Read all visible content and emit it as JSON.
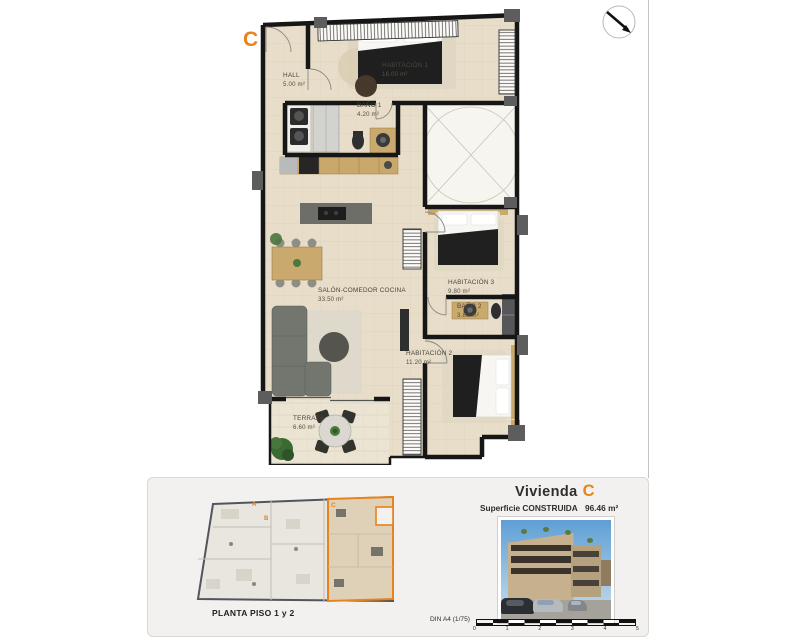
{
  "colors": {
    "accent": "#e8831c",
    "wall": "#161616",
    "floor": "#e7ddc9"
  },
  "plan": {
    "unit_letter": "C",
    "rooms": [
      {
        "name": "HALL",
        "area": "5.00 m²"
      },
      {
        "name": "HABITACIÓN 1",
        "area": "16.00 m²"
      },
      {
        "name": "BAÑO 1",
        "area": "4.20 m²"
      },
      {
        "name": "SALÓN-COMEDOR COCINA",
        "area": "33.50 m²"
      },
      {
        "name": "HABITACIÓN 3",
        "area": "9.80 m²"
      },
      {
        "name": "BAÑO 2",
        "area": "3.80 m²"
      },
      {
        "name": "HABITACIÓN 2",
        "area": "11.20 m²"
      },
      {
        "name": "TERRAZA",
        "area": "6.60 m²"
      }
    ]
  },
  "panel": {
    "mini_plan": {
      "caption": "PLANTA PISO 1 y 2",
      "unit_a": "A",
      "unit_b": "B",
      "unit_c": "C"
    },
    "title": {
      "prefix": "Vivienda",
      "unit": "C"
    },
    "surface": {
      "label": "Superficie CONSTRUIDA",
      "value": "96.46 m²"
    },
    "scale": {
      "label": "DIN A4 (1/75)",
      "ticks": [
        "0",
        "1",
        "2",
        "3",
        "4",
        "5"
      ]
    }
  }
}
